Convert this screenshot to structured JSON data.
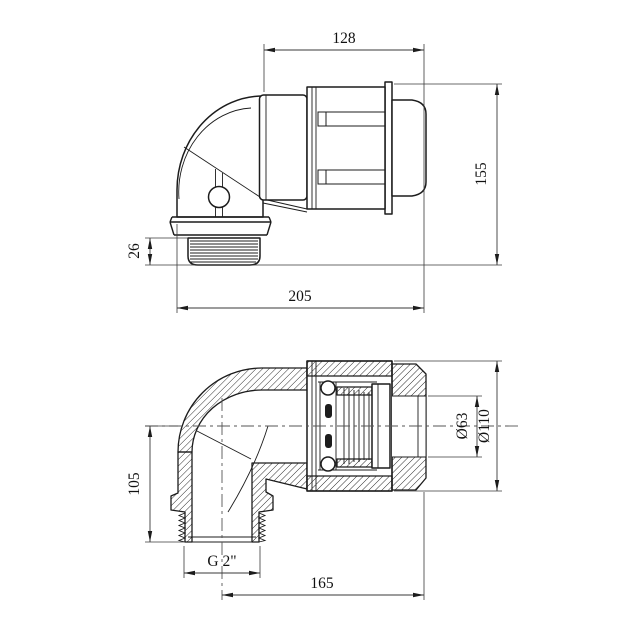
{
  "drawing": {
    "views": {
      "external": {
        "dims": {
          "top_width": "128",
          "overall_height": "155",
          "thread_length": "26",
          "overall_width": "205"
        }
      },
      "section": {
        "dims": {
          "axis_height": "105",
          "pipe_diameter": "Ø63",
          "body_diameter": "Ø110",
          "length": "165",
          "thread_size": "G 2\""
        }
      }
    }
  }
}
